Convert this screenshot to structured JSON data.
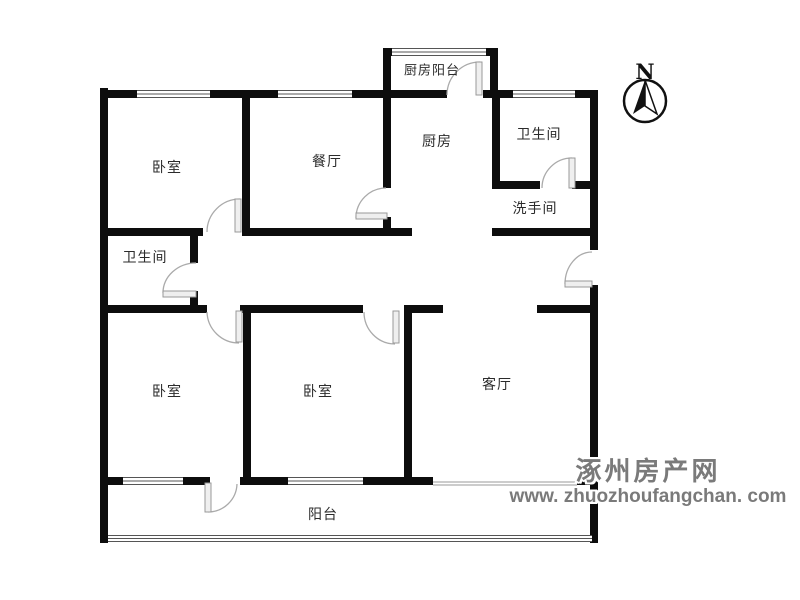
{
  "rooms": {
    "bedroom_top_left": "卧室",
    "dining": "餐厅",
    "kitchen_balcony": "厨房阳台",
    "kitchen": "厨房",
    "bathroom_top_right": "卫生间",
    "washroom": "洗手间",
    "bathroom_left": "卫生间",
    "bedroom_bottom_left": "卧室",
    "bedroom_bottom_middle": "卧室",
    "living_room": "客厅",
    "balcony": "阳台"
  },
  "compass": {
    "north_label": "N"
  },
  "watermark": {
    "site_name": "涿州房产网",
    "site_url": "www. zhuozhoufangchan. com",
    "text_color": "#7a7a7a"
  },
  "colors": {
    "wall": "#0d0d0d",
    "door_arc": "#aaaaaa",
    "background": "#ffffff"
  }
}
